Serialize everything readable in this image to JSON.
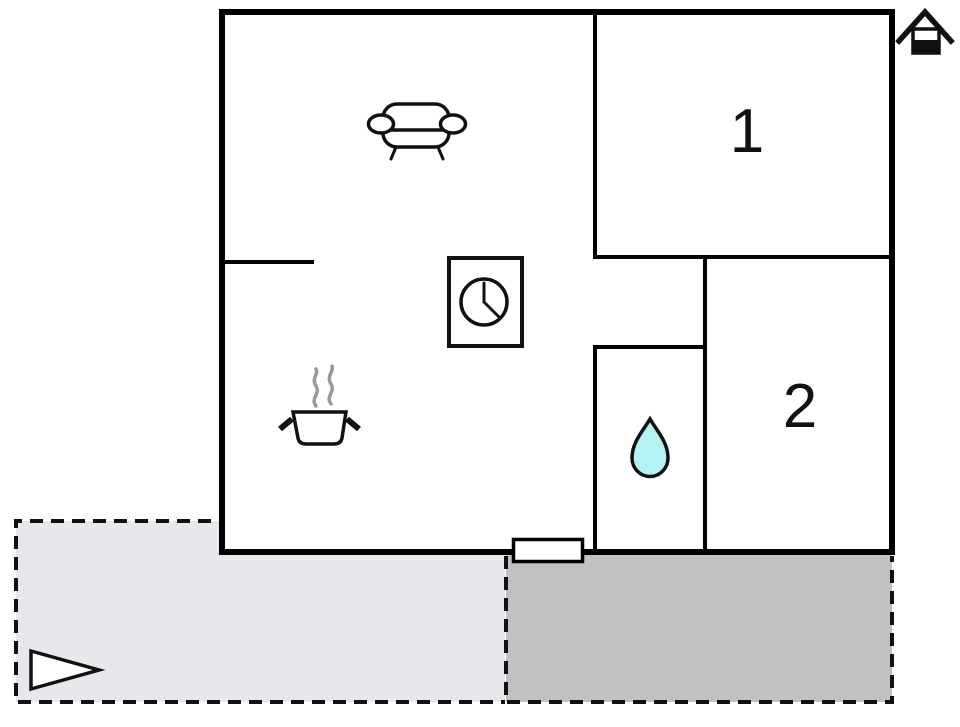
{
  "rooms": {
    "room1": {
      "label": "1"
    },
    "room2": {
      "label": "2"
    }
  },
  "icons": [
    {
      "name": "sofa-icon",
      "shape": "sofa-front-view"
    },
    {
      "name": "clock-icon",
      "shape": "clock-in-rectangle"
    },
    {
      "name": "cooking-pot-icon",
      "shape": "pot-with-steam"
    },
    {
      "name": "water-drop-icon",
      "shape": "teardrop"
    },
    {
      "name": "entrance-arrow-icon",
      "shape": "right-pointing-triangle"
    },
    {
      "name": "house-icon",
      "shape": "house-pictogram"
    },
    {
      "name": "entrance-door",
      "shape": "door-rectangle"
    }
  ],
  "colors": {
    "wall": "#000000",
    "icon_stroke": "#111111",
    "veranda_fill": "#e8e8ec",
    "terrace_fill": "#c1c1c3",
    "water_drop": "#b5f2f2",
    "steam": "#999999",
    "background": "#ffffff"
  }
}
